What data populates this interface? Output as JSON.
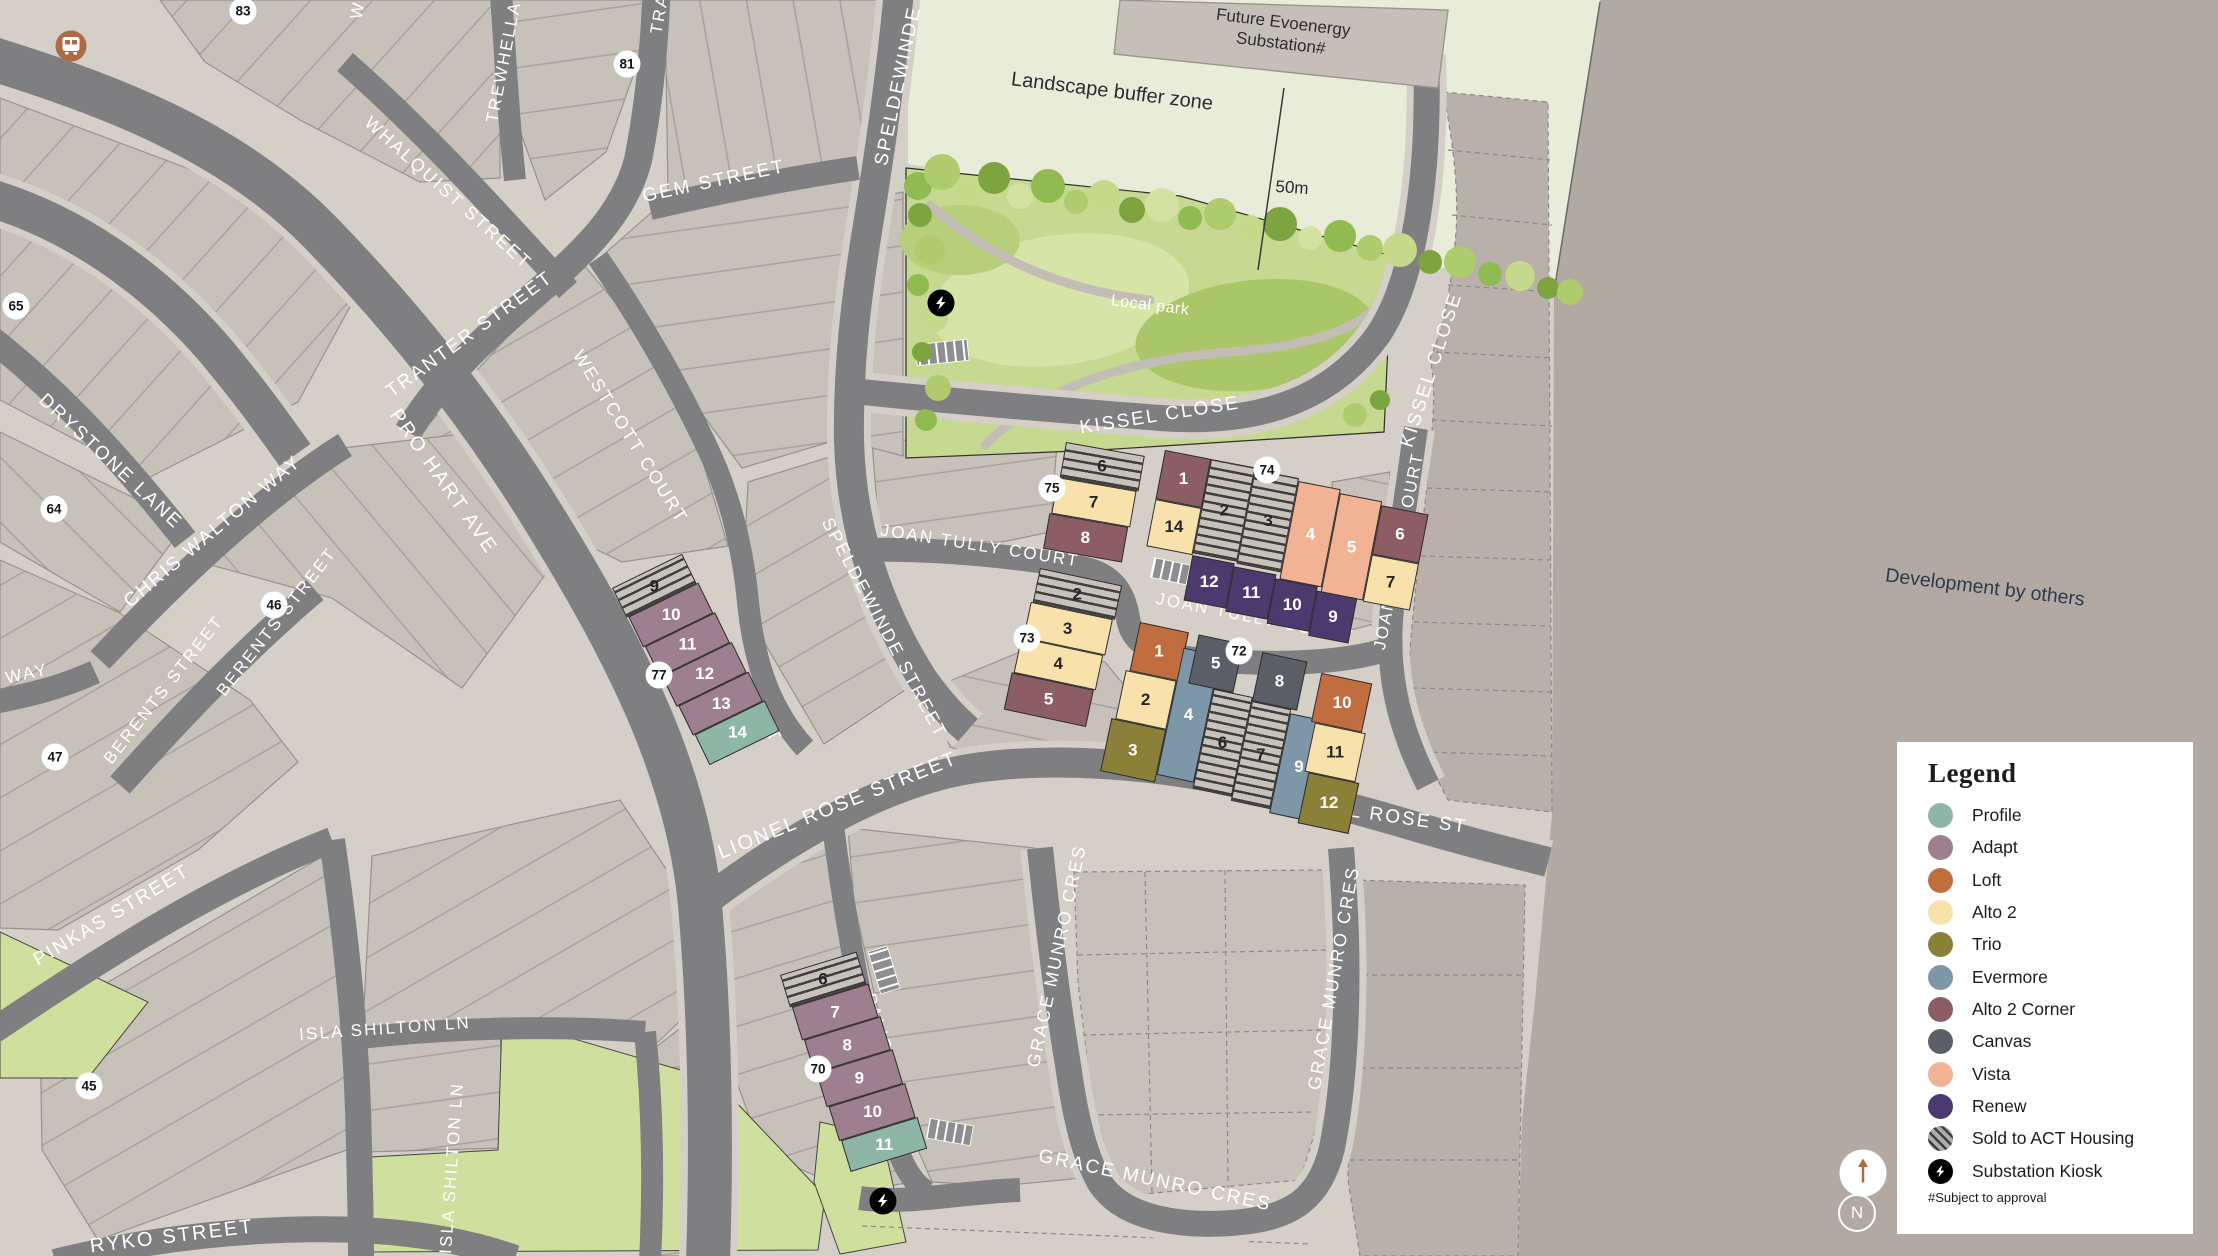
{
  "palette": {
    "profile": "#8eb6a6",
    "adapt": "#9d7f90",
    "loft": "#c06e40",
    "alto2": "#f8e1ab",
    "trio": "#8a8037",
    "evermore": "#7d96a8",
    "altoc": "#8c5e63",
    "canvas": "#5c5f68",
    "vista": "#f1b394",
    "renew": "#4c3a6e",
    "road": "#7f7e81",
    "footpath": "#d5cfc8",
    "block": "#c8c1ba",
    "dev_background": "#b2a9a2",
    "buffer_zone": "#e9ecd8",
    "park": "#c5d990",
    "green_space": "#cfdf9d",
    "accent_orange": "#ad6a44"
  },
  "legend": {
    "title": "Legend",
    "footnote": "#Subject to approval",
    "items": [
      {
        "label": "Profile",
        "color": "#8eb6a6"
      },
      {
        "label": "Adapt",
        "color": "#9d7f90"
      },
      {
        "label": "Loft",
        "color": "#c06e40"
      },
      {
        "label": "Alto 2",
        "color": "#f8e1ab"
      },
      {
        "label": "Trio",
        "color": "#8a8037"
      },
      {
        "label": "Evermore",
        "color": "#7d96a8"
      },
      {
        "label": "Alto 2 Corner",
        "color": "#8c5e63"
      },
      {
        "label": "Canvas",
        "color": "#5c5f68"
      },
      {
        "label": "Vista",
        "color": "#f1b394"
      },
      {
        "label": "Renew",
        "color": "#4c3a6e"
      },
      {
        "label": "Sold to ACT Housing",
        "color": "hatch"
      },
      {
        "label": "Substation Kiosk",
        "color": "#000000"
      }
    ]
  },
  "streets": {
    "gem": "GEM STREET",
    "speldewinde_top": "SPELDEWINDE S",
    "speldewinde_mid": "SPELDEWINDE STREET",
    "trewhella": "TREWHELLA",
    "whalquist": "WHALQUIST STREET",
    "tranter": "TRANTER STREET",
    "tra_frag": "TRA",
    "w_frag": "W",
    "westcott_upper": "WESTCOTT COURT",
    "westcott_lower": "WESTCOTT COURT",
    "drystone": "DRYSTONE LANE",
    "chris_walton": "CHRIS WALTON WAY",
    "pro_hart": "PRO HART AVE",
    "berents_a": "BERENTS STREET",
    "berents_b": "BERENTS STREET",
    "way_frag": "WAY",
    "pinkas": "PINKAS STREET",
    "isla_h": "ISLA SHILTON LN",
    "isla_v": "ISLA SHILTON LN",
    "ryko": "RYKO STREET",
    "lionel_w": "LIONEL ROSE STREET",
    "lionel_e": "LIONEL ROSE ST",
    "joan_a": "JOAN TULLY COURT",
    "joan_b": "JOAN TULLY COURT",
    "joan_v": "JOAN TULLY COURT",
    "kissel_h": "KISSEL CLOSE",
    "kissel_v": "KISSEL CLOSE",
    "gmc_w": "GRACE MUNRO CRES",
    "gmc_e": "GRACE MUNRO CRES",
    "gmc_b": "GRACE MUNRO CRES",
    "palisade": "PALISADE LANE"
  },
  "annotations": {
    "substation_line1": "Future Evoenergy",
    "substation_line2": "Substation#",
    "buffer": "Landscape buffer zone",
    "dimension": "50m",
    "local_park": "Local park",
    "development": "Development by others"
  },
  "markers": {
    "m83": "83",
    "m81": "81",
    "m65": "65",
    "m64": "64",
    "m47": "47",
    "m46": "46",
    "m45": "45",
    "m77": "77",
    "m75": "75",
    "m74": "74",
    "m73": "73",
    "m72": "72",
    "m70": "70"
  },
  "compass": {
    "north": "N"
  },
  "clusters": {
    "c77": {
      "lots": [
        {
          "n": "9",
          "type": "hatch"
        },
        {
          "n": "10",
          "type": "adapt"
        },
        {
          "n": "11",
          "type": "adapt"
        },
        {
          "n": "12",
          "type": "adapt"
        },
        {
          "n": "13",
          "type": "adapt"
        },
        {
          "n": "14",
          "type": "profile"
        }
      ]
    },
    "c70": {
      "lots": [
        {
          "n": "6",
          "type": "hatch"
        },
        {
          "n": "7",
          "type": "adapt"
        },
        {
          "n": "8",
          "type": "adapt"
        },
        {
          "n": "9",
          "type": "adapt"
        },
        {
          "n": "10",
          "type": "adapt"
        },
        {
          "n": "11",
          "type": "profile"
        }
      ]
    },
    "c73": {
      "lots": [
        {
          "n": "2",
          "type": "hatch"
        },
        {
          "n": "3",
          "type": "alto2"
        },
        {
          "n": "4",
          "type": "alto2"
        },
        {
          "n": "5",
          "type": "altoc"
        }
      ]
    },
    "c75": {
      "lots": [
        {
          "n": "6",
          "type": "hatch"
        },
        {
          "n": "7",
          "type": "alto2"
        },
        {
          "n": "8",
          "type": "altoc"
        }
      ]
    },
    "c74": {
      "lots": [
        {
          "n": "1",
          "type": "altoc"
        },
        {
          "n": "14",
          "type": "alto2"
        },
        {
          "n": "2",
          "type": "hatch"
        },
        {
          "n": "3",
          "type": "hatch"
        },
        {
          "n": "4",
          "type": "vista"
        },
        {
          "n": "5",
          "type": "vista"
        },
        {
          "n": "6",
          "type": "altoc"
        },
        {
          "n": "7",
          "type": "alto2"
        },
        {
          "n": "12",
          "type": "renew"
        },
        {
          "n": "11",
          "type": "renew"
        },
        {
          "n": "10",
          "type": "renew"
        },
        {
          "n": "9",
          "type": "renew"
        }
      ]
    },
    "c72": {
      "lots": [
        {
          "n": "1",
          "type": "loft"
        },
        {
          "n": "2",
          "type": "alto2"
        },
        {
          "n": "3",
          "type": "trio"
        },
        {
          "n": "4",
          "type": "evermore"
        },
        {
          "n": "5",
          "type": "canvas"
        },
        {
          "n": "6",
          "type": "hatch"
        },
        {
          "n": "7",
          "type": "hatch"
        },
        {
          "n": "8",
          "type": "canvas"
        },
        {
          "n": "9",
          "type": "evermore"
        },
        {
          "n": "10",
          "type": "loft"
        },
        {
          "n": "11",
          "type": "alto2"
        },
        {
          "n": "12",
          "type": "trio"
        }
      ]
    }
  }
}
